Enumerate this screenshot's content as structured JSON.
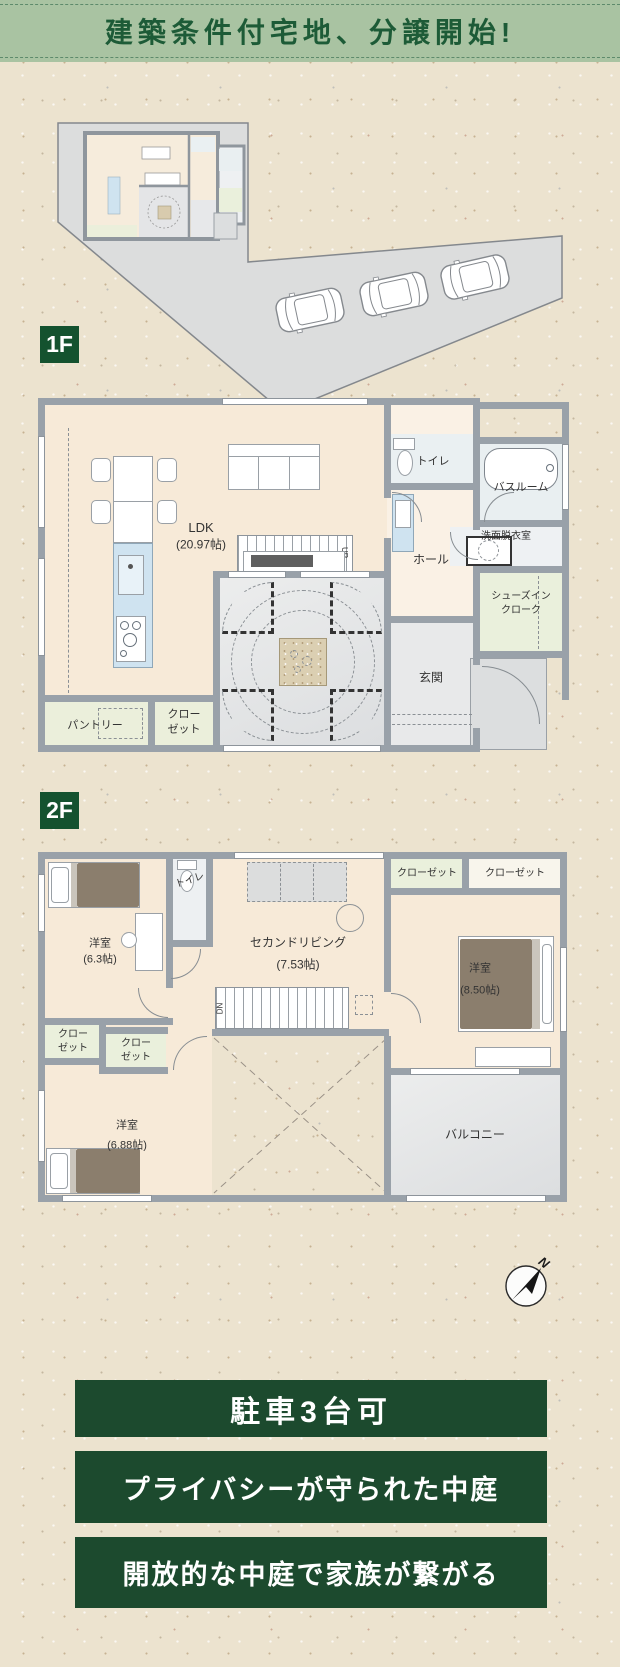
{
  "header": {
    "title": "建築条件付宅地、分譲開始!"
  },
  "site_plan": {
    "car_count": 3
  },
  "floor1": {
    "badge": "1F",
    "ldk": {
      "name": "LDK",
      "size": "(20.97帖)"
    },
    "toilet": "トイレ",
    "bathroom": "バスルーム",
    "washroom": "洗面脱衣室",
    "hall": "ホール",
    "shoe_closet": {
      "l1": "シューズイン",
      "l2": "クローク"
    },
    "entrance": "玄関",
    "pantry": "パントリー",
    "closet": {
      "l1": "クロー",
      "l2": "ゼット"
    },
    "stairs_label": "UP"
  },
  "floor2": {
    "badge": "2F",
    "bedroom_a": {
      "name": "洋室",
      "size": "(6.3帖)"
    },
    "toilet": "トイレ",
    "second_living": {
      "name": "セカンドリビング",
      "size": "(7.53帖)"
    },
    "closet_a": "クローゼット",
    "closet_b": "クローゼット",
    "bedroom_b": {
      "name": "洋室",
      "size": "(8.50帖)"
    },
    "closet_c": {
      "l1": "クロー",
      "l2": "ゼット"
    },
    "closet_d": {
      "l1": "クロー",
      "l2": "ゼット"
    },
    "bedroom_c": {
      "name": "洋室",
      "size": "(6.88帖)"
    },
    "balcony": "バルコニー",
    "stairs_label": "DN"
  },
  "compass": {
    "north": "N"
  },
  "banners": {
    "parking": "駐車3台可",
    "privacy": "プライバシーが守られた中庭",
    "open_court": "開放的な中庭で家族が繋がる"
  },
  "colors": {
    "paper_bg": "#ece3cf",
    "header_bg": "#a9c3a2",
    "header_text": "#1d5b37",
    "badge_bg": "#14522f",
    "banner_bg": "#1c4a2e",
    "banner_text": "#ffffff",
    "wall_gray": "#99a1a9",
    "floor_cream": "#f7ead8",
    "closet_green": "#eaf0dc",
    "kitchen_blue": "#cfe3f0",
    "courtyard_gray": "#e2e4e6"
  }
}
